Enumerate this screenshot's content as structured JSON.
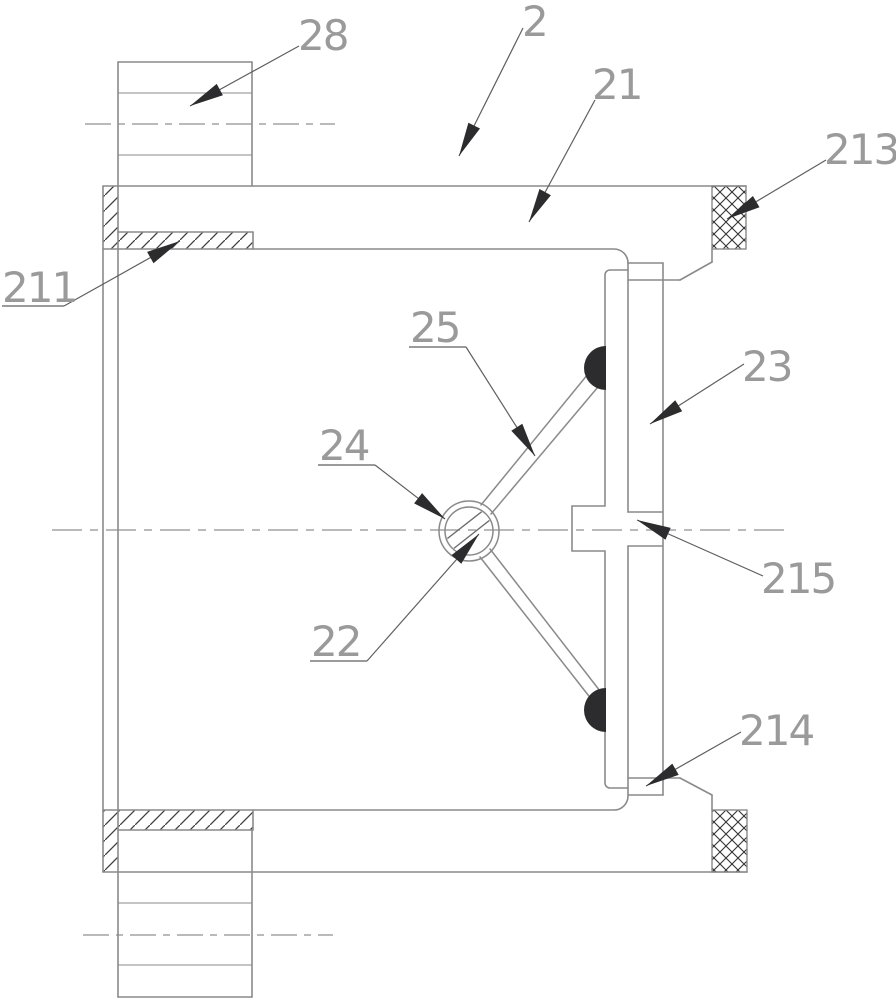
{
  "figure": {
    "kind": "patent-sectional-drawing",
    "labels": {
      "n2": "2",
      "n21": "21",
      "n211": "211",
      "n213": "213",
      "n28": "28",
      "n25": "25",
      "n24": "24",
      "n22": "22",
      "n23": "23",
      "n215": "215",
      "n214": "214"
    },
    "colors": {
      "line": "#8a8a8a",
      "dark_line": "#6e6e6e",
      "leader": "#5f5f5f",
      "fill_dark": "#2c2c2e",
      "hatch": "#3f3f3f",
      "centerline": "#a3a3a3",
      "label": "#9a9a9a"
    }
  }
}
